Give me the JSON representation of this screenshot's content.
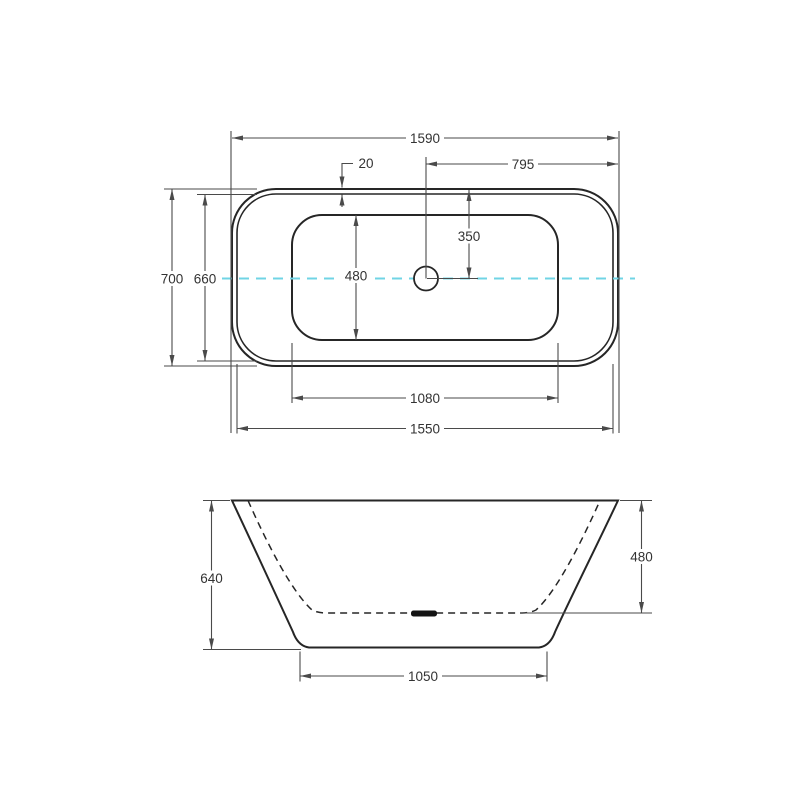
{
  "colors": {
    "background": "#ffffff",
    "object_line": "#262626",
    "dimension_line": "#4a4a4a",
    "text": "#333333",
    "centerline": "#70d4e5",
    "drain_fill": "#141414"
  },
  "top_view": {
    "dimensions": {
      "overall_length": "1590",
      "rim_width": "20",
      "half_length": "795",
      "drain_offset": "350",
      "overall_width": "700",
      "inner_rim_width": "660",
      "basin_width": "480",
      "basin_length": "1080",
      "inner_rim_length": "1550"
    }
  },
  "side_view": {
    "dimensions": {
      "overall_height": "640",
      "inner_depth": "480",
      "base_width": "1050"
    }
  }
}
